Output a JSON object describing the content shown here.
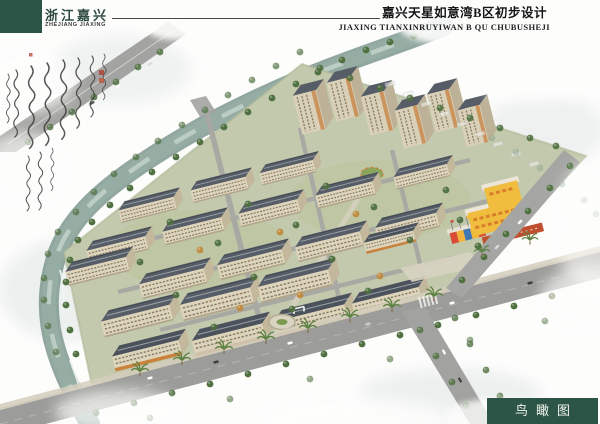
{
  "header": {
    "brand_cn": "浙江嘉兴",
    "brand_en": "ZHEJIANG JIAXING",
    "title_cn": "嘉兴天星如意湾B区初步设计",
    "title_en": "JIAXING TIANXINRUYIWAN B QU CHUBUSHEJI"
  },
  "footer": {
    "view_label": "鸟瞰图"
  },
  "colors": {
    "brand_block_green": "#2c5547",
    "label_box_green": "#2c5547",
    "title_text": "#151515",
    "brand_text": "#2e4a40",
    "water": "#96ada4",
    "road": "#9c9c9a",
    "site_green": "#c3c9ad",
    "roof_slate": "#575d66",
    "facade_cream": "#ded4bb",
    "accent_orange": "#c9823e",
    "kindergarten_yellow": "#f0bd3e",
    "seal_red": "#b23726",
    "tree_green": "#4f7040"
  }
}
